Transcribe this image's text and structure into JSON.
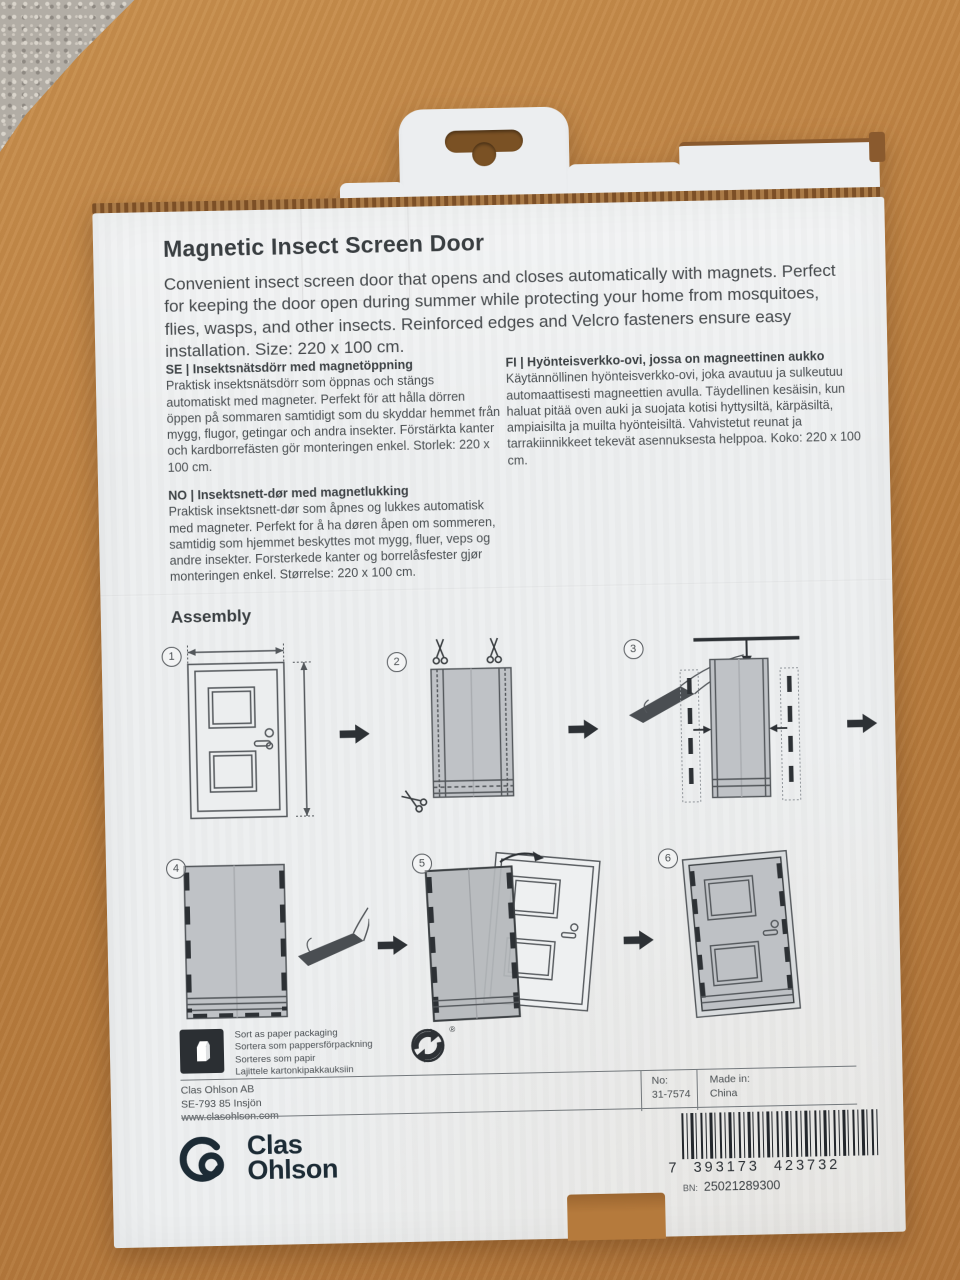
{
  "colors": {
    "box_face": "#edeff0",
    "wood": "#b87c3f",
    "cardboard_edge": "#8a5a2e",
    "print_text": "#42474a",
    "diagram_black": "#2d3135",
    "brand_navy": "#1c2b35"
  },
  "product": {
    "title": "Magnetic Insect Screen Door",
    "description": "Convenient insect screen door that opens and closes automatically with magnets. Perfect for keeping the door open during summer while protecting your home from mosquitoes, flies, wasps, and other insects. Reinforced edges and Velcro fasteners ensure easy installation. Size: 220 x 100 cm."
  },
  "descriptions": {
    "se": {
      "heading": "SE | Insektsnätsdörr med magnetöppning",
      "body": "Praktisk insektsnätsdörr som öppnas och stängs automatiskt med magneter. Perfekt för att hålla dörren öppen på sommaren samtidigt som du skyddar hemmet från mygg, flugor, getingar och andra insekter. Förstärkta kanter och kardborrefästen gör monteringen enkel. Storlek: 220 x 100 cm."
    },
    "no": {
      "heading": "NO | Insektsnett-dør med magnetlukking",
      "body": "Praktisk insektsnett-dør som åpnes og lukkes automatisk med magneter. Perfekt for å ha døren åpen om sommeren, samtidig som hjemmet beskyttes mot mygg, fluer, veps og andre insekter. Forsterkede kanter og borrelåsfester gjør monteringen enkel. Størrelse: 220 x 100 cm."
    },
    "fi": {
      "heading": "FI | Hyönteisverkko-ovi, jossa on magneettinen aukko",
      "body": "Käytännöllinen hyönteisverkko-ovi, joka avautuu ja sulkeutuu automaattisesti magneettien avulla. Täydellinen kesäisin, kun haluat pitää oven auki ja suojata kotisi hyttysiltä, kärpäsiltä, ampiaisilta ja muilta hyönteisiltä. Vahvistetut reunat ja tarrakiinnikkeet tekevät asennuksesta helppoa. Koko: 220 x 100 cm."
    }
  },
  "assembly": {
    "heading": "Assembly",
    "steps": [
      {
        "number": "1",
        "icon": "door-measurement-diagram"
      },
      {
        "number": "2",
        "icon": "mesh-cut-scissors-diagram"
      },
      {
        "number": "3",
        "icon": "mesh-width-adjust-tape-diagram"
      },
      {
        "number": "4",
        "icon": "mesh-velcro-edges-diagram"
      },
      {
        "number": "5",
        "icon": "mount-mesh-on-door-diagram"
      },
      {
        "number": "6",
        "icon": "finished-installation-diagram"
      }
    ]
  },
  "recycling": {
    "lines": [
      "Sort as paper packaging",
      "Sortera som pappersförpackning",
      "Sorteres som papir",
      "Lajittele kartonkipakkauksiin"
    ],
    "registered": "®",
    "icons": [
      "paper-carton-icon",
      "green-dot-recycling-icon"
    ]
  },
  "footer": {
    "company": "Clas Ohlson AB",
    "address": "SE-793 85 Insjön",
    "website": "www.clasohlson.com",
    "no_label": "No:",
    "no_value": "31-7574",
    "made_in_label": "Made in:",
    "made_in_value": "China"
  },
  "brand": {
    "line1": "Clas",
    "line2": "Ohlson"
  },
  "barcode": {
    "d1": "7",
    "d2": "393173",
    "d3": "423732",
    "full": "7 393173 423732",
    "bn_label": "BN:",
    "bn_value": "25021289300"
  }
}
